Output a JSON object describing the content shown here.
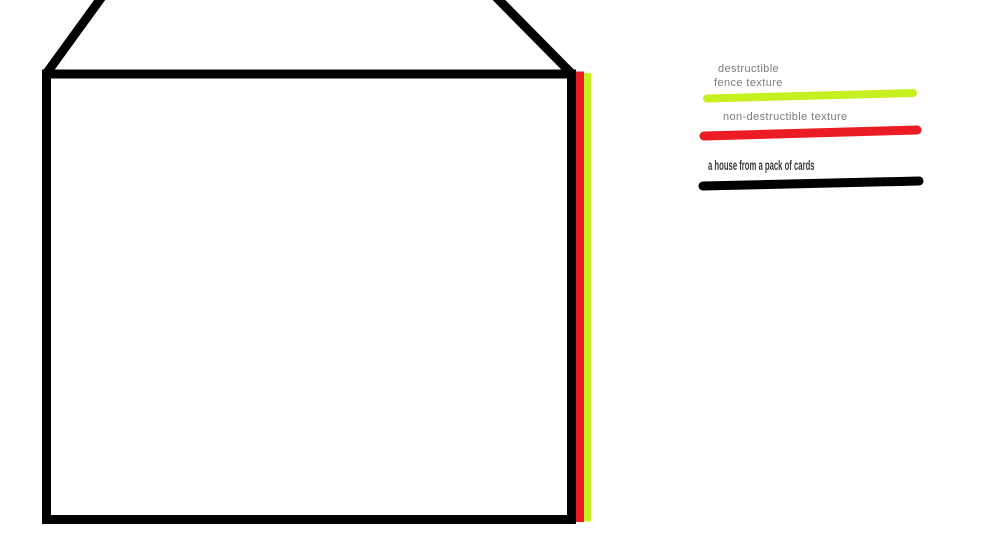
{
  "canvas": {
    "background": "#ffffff"
  },
  "colors": {
    "house_outline": "#000000",
    "destructible": "#c7f021",
    "non_destructible": "#ec1c24",
    "legend_text_gray": "#7b7b7b",
    "legend_text_dark": "#3b3b3b"
  },
  "legend": {
    "destructible": {
      "line1": "destructible",
      "line2": "fence texture"
    },
    "non_destructible": {
      "label": "non-destructible texture"
    },
    "house": {
      "label": "a house from a pack of cards"
    }
  }
}
